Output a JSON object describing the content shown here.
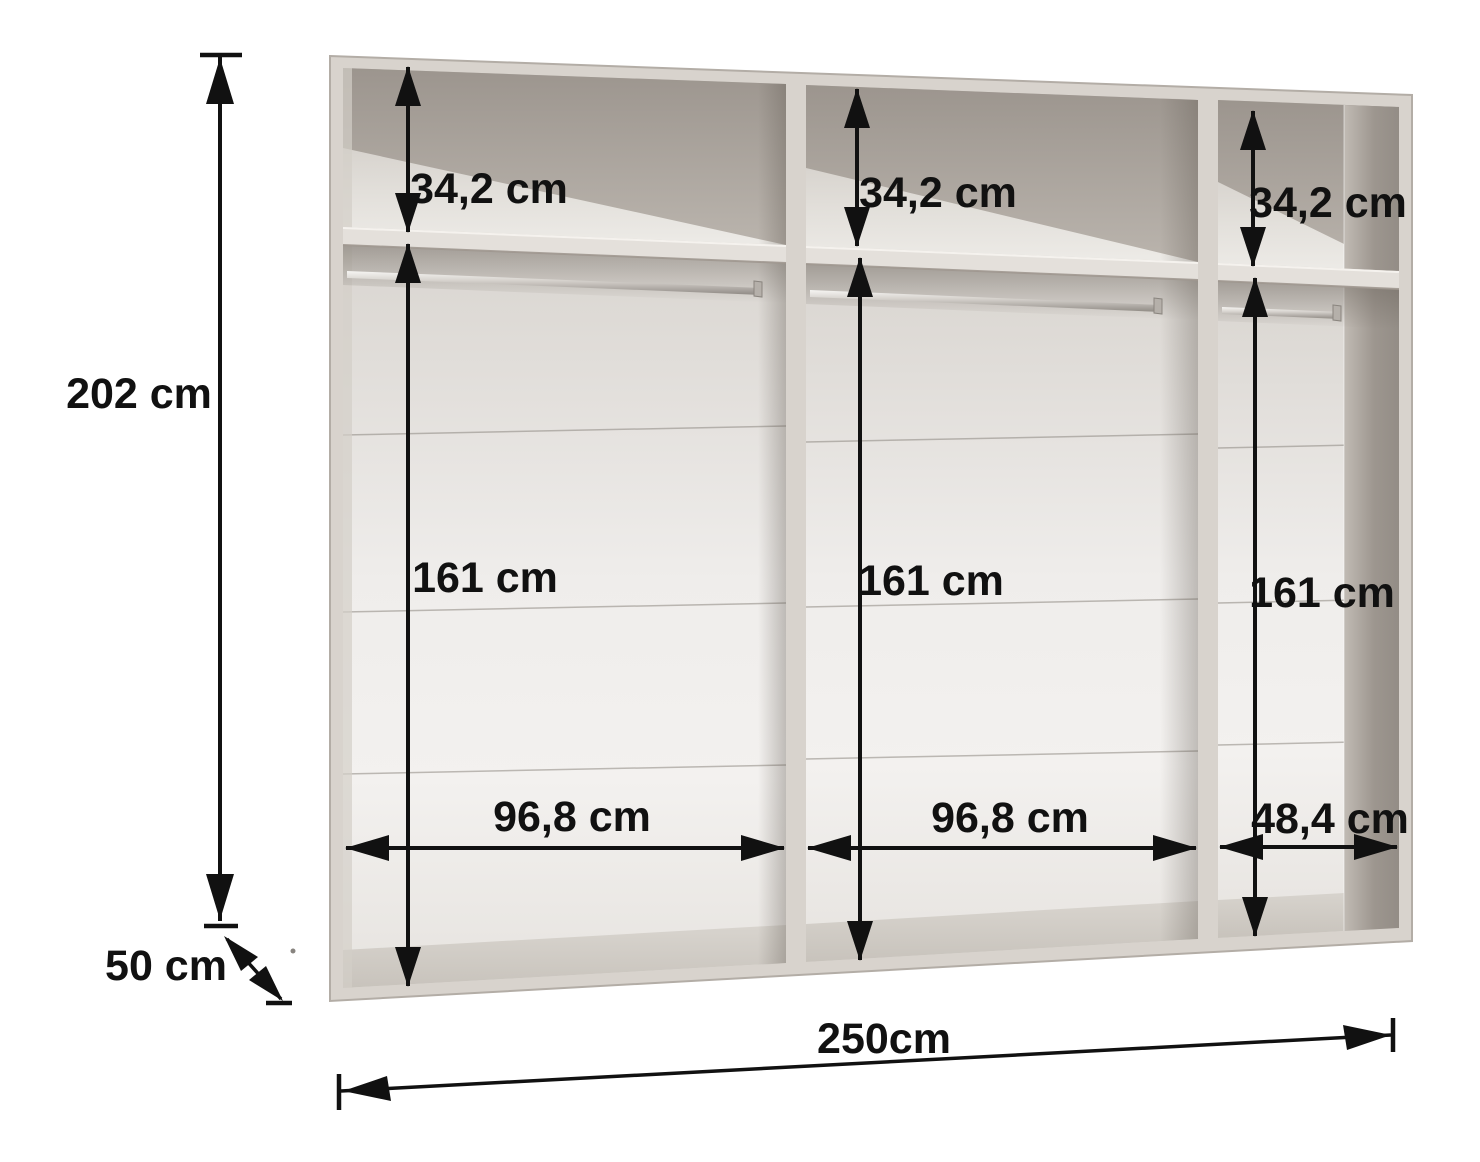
{
  "diagram": {
    "type": "wardrobe-interior-dimension-diagram",
    "unit": "cm",
    "overall": {
      "height": "202 cm",
      "depth": "50 cm",
      "width": "250cm"
    },
    "compartments": [
      {
        "name": "left",
        "shelf_section_height": "34,2 cm",
        "hanging_section_height": "161 cm",
        "width": "96,8 cm"
      },
      {
        "name": "middle",
        "shelf_section_height": "34,2 cm",
        "hanging_section_height": "161 cm",
        "width": "96,8 cm"
      },
      {
        "name": "right",
        "shelf_section_height": "34,2 cm",
        "hanging_section_height": "161 cm",
        "width": "48,4 cm"
      }
    ],
    "colors": {
      "ink": "#111111",
      "carcass": "#d8d3cd",
      "carcass-edge": "#b3ada6",
      "interior-light": "#f0eeec",
      "interior-shadow": "#9b948d",
      "background": "#ffffff"
    }
  }
}
